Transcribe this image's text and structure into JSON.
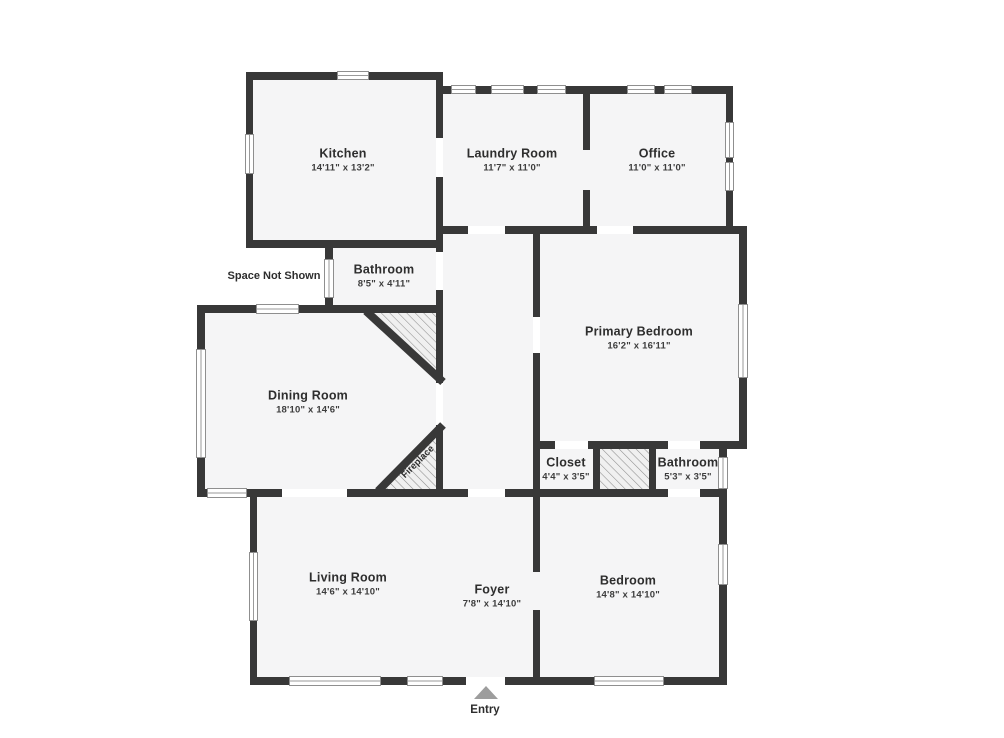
{
  "floorplan": {
    "rooms": [
      {
        "id": "kitchen",
        "name": "Kitchen",
        "dims": "14'11\" x 13'2\""
      },
      {
        "id": "laundry-room",
        "name": "Laundry Room",
        "dims": "11'7\" x 11'0\""
      },
      {
        "id": "office",
        "name": "Office",
        "dims": "11'0\" x 11'0\""
      },
      {
        "id": "bathroom-top",
        "name": "Bathroom",
        "dims": "8'5\" x 4'11\""
      },
      {
        "id": "primary-bedroom",
        "name": "Primary Bedroom",
        "dims": "16'2\" x 16'11\""
      },
      {
        "id": "dining-room",
        "name": "Dining Room",
        "dims": "18'10\" x 14'6\""
      },
      {
        "id": "closet",
        "name": "Closet",
        "dims": "4'4\" x 3'5\""
      },
      {
        "id": "bathroom-small",
        "name": "Bathroom",
        "dims": "5'3\" x 3'5\""
      },
      {
        "id": "living-room",
        "name": "Living Room",
        "dims": "14'6\" x 14'10\""
      },
      {
        "id": "foyer",
        "name": "Foyer",
        "dims": "7'8\" x 14'10\""
      },
      {
        "id": "bedroom",
        "name": "Bedroom",
        "dims": "14'8\" x 14'10\""
      }
    ],
    "annotations": {
      "space_not_shown": "Space Not Shown",
      "fireplace": "Fireplace",
      "entry": "Entry"
    },
    "colors": {
      "wall": "#383838",
      "room_fill": "#f5f5f6",
      "hatch_line": "#8e8e8e",
      "entry_arrow": "#9d9d9d"
    }
  }
}
